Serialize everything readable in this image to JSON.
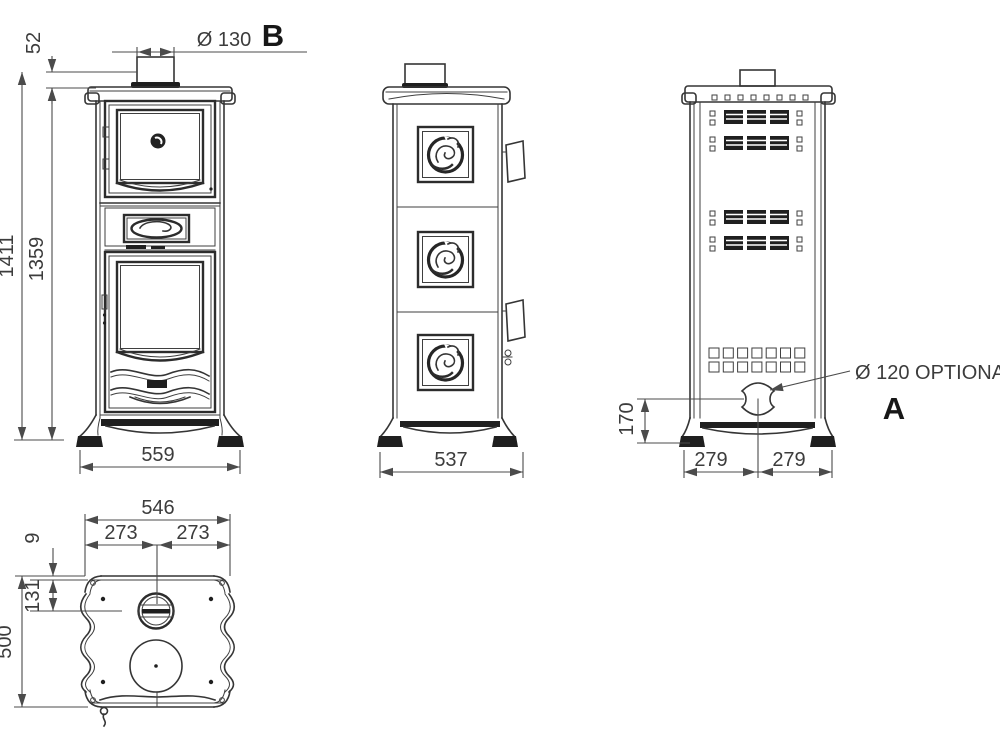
{
  "drawing": {
    "front_view": {
      "label": "B",
      "dim_flue_collar_height": "52",
      "dim_total_height": "1411",
      "dim_body_height": "1359",
      "dim_flue_diameter": "Ø 130",
      "dim_width": "559"
    },
    "side_view": {
      "dim_depth": "537"
    },
    "back_view": {
      "label": "A",
      "dim_outlet_center_height": "170",
      "dim_half_width_left": "279",
      "dim_half_width_right": "279",
      "flue_outlet_note": "Ø 120 OPTIONAL"
    },
    "top_view": {
      "dim_width": "546",
      "dim_half_width_left": "273",
      "dim_half_width_right": "273",
      "dim_rear_edge_offset": "9",
      "dim_flue_center_offset": "131",
      "dim_depth": "500"
    }
  }
}
